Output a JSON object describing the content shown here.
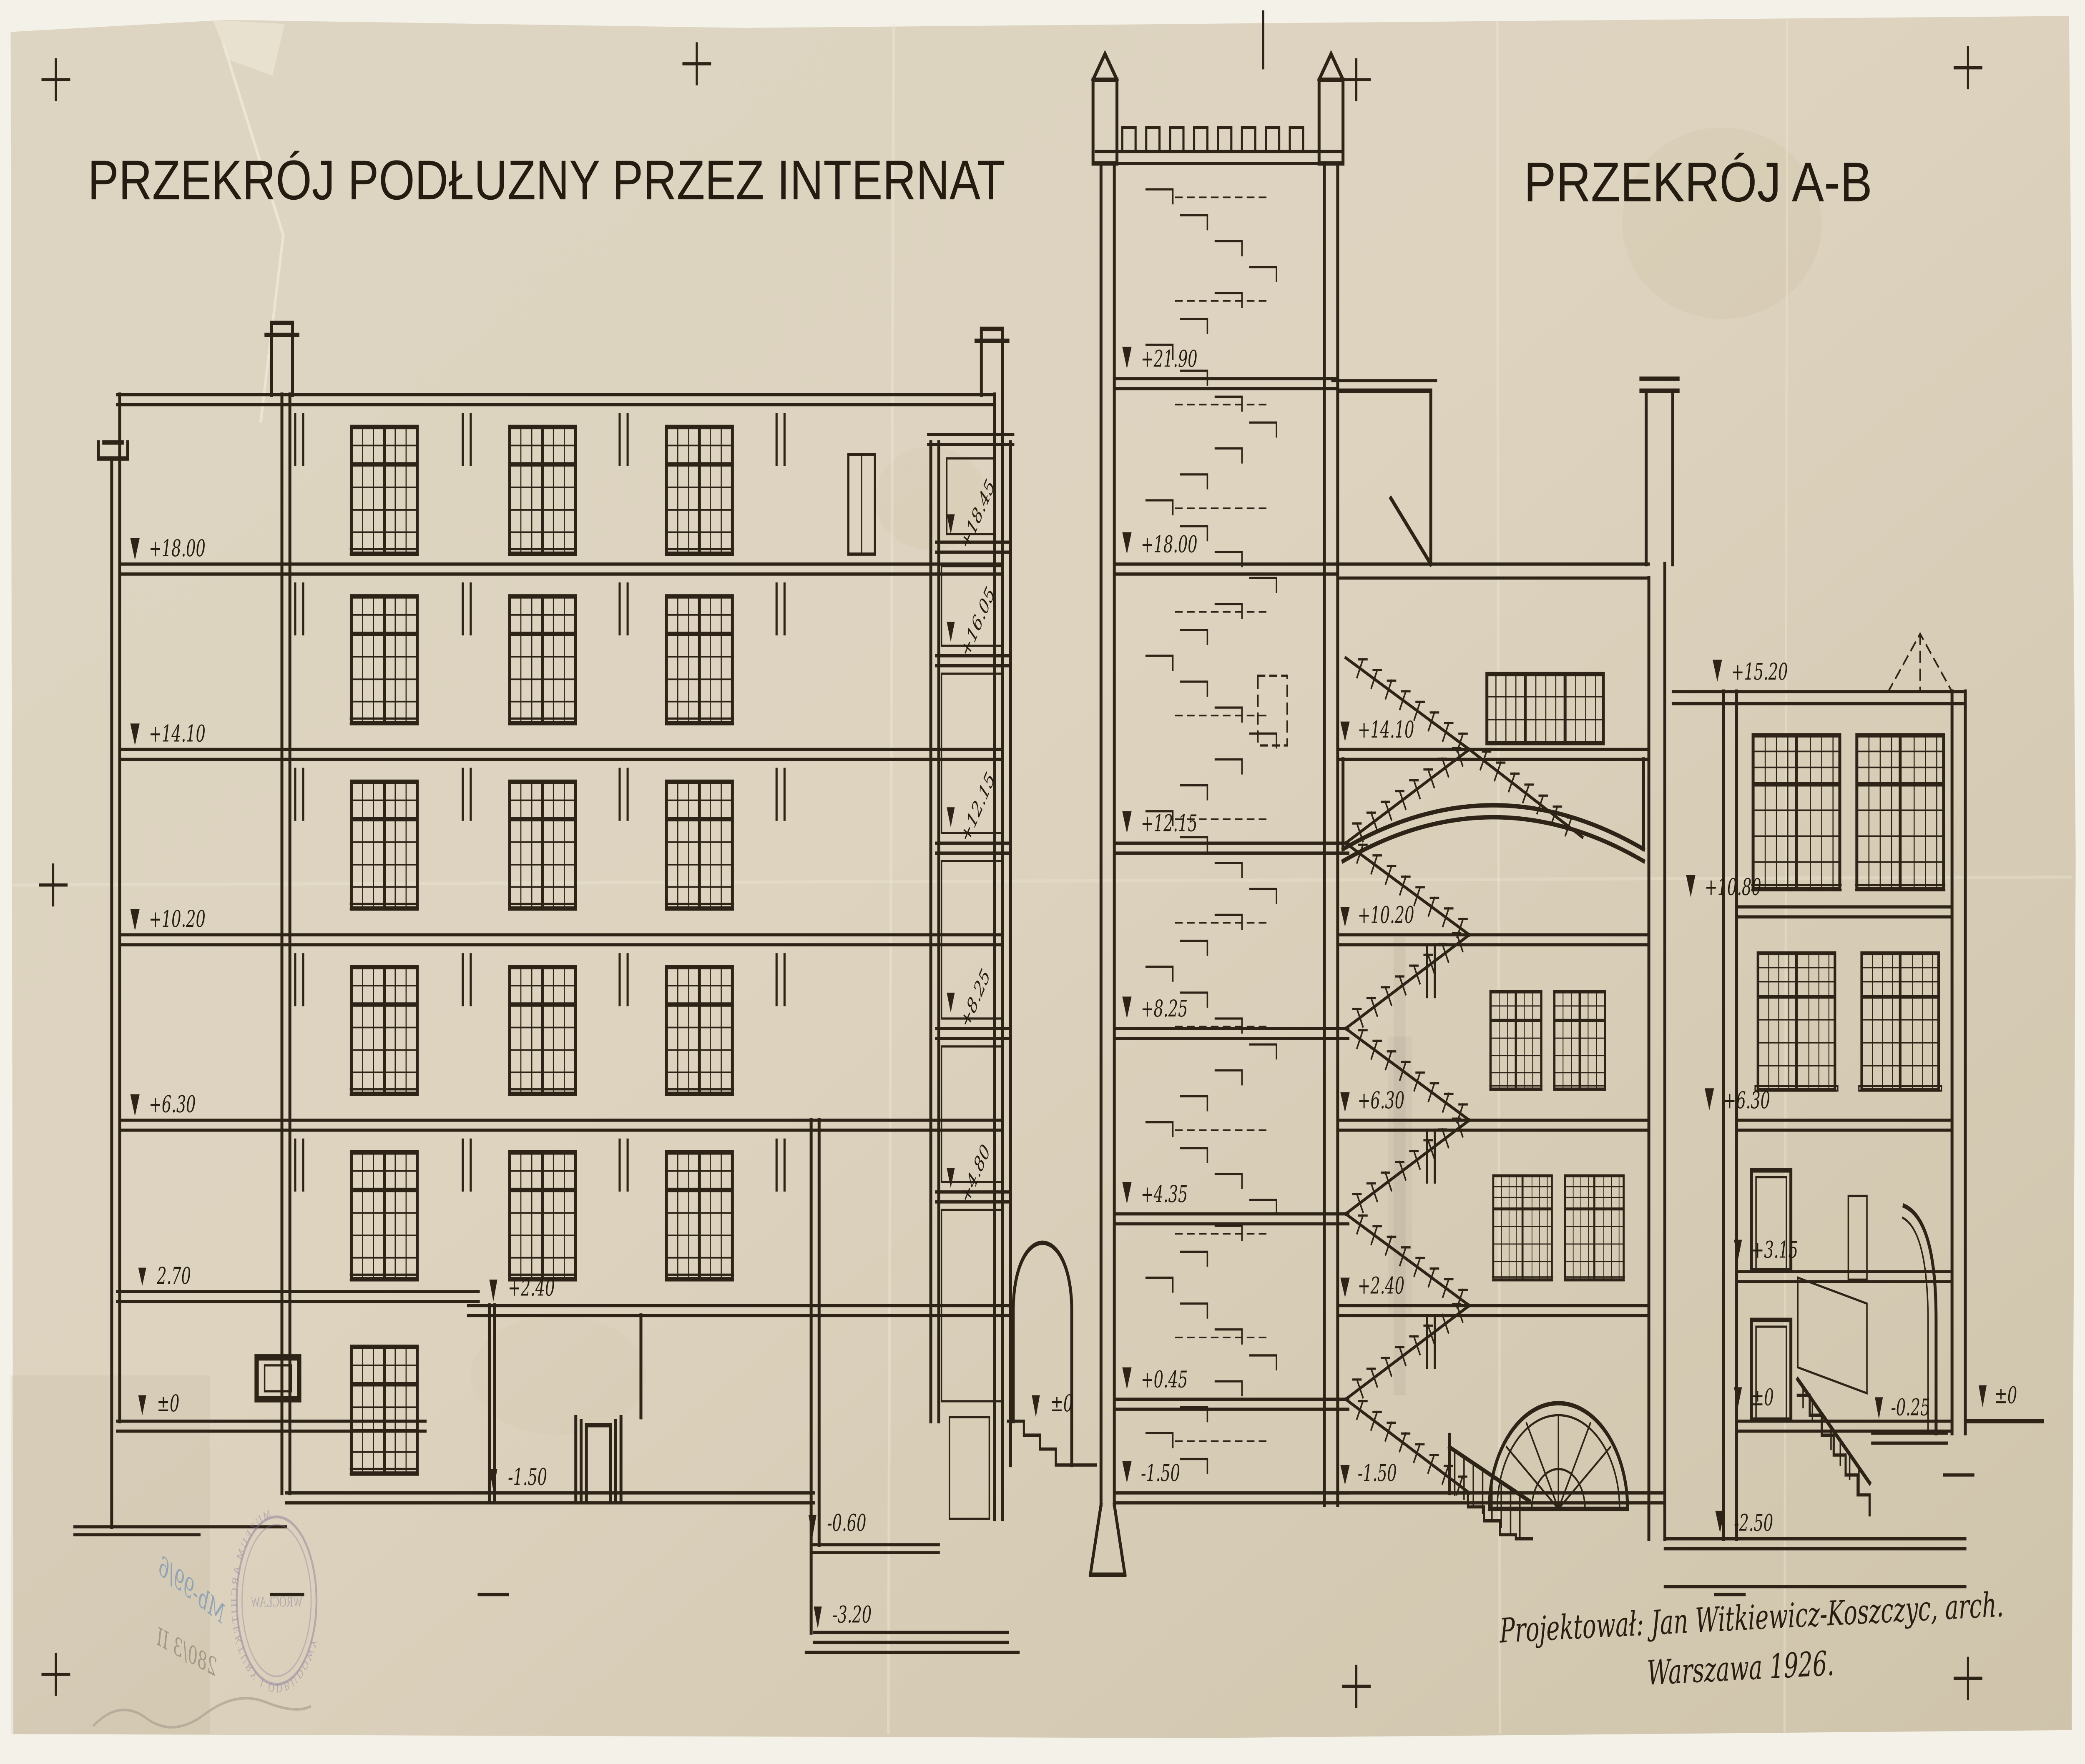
{
  "titles": {
    "left": "PRZEKRÓJ PODŁUZNY PRZEZ INTERNAT",
    "right": "PRZEKRÓJ A-B"
  },
  "left_section": {
    "wall_marks": [
      "+18.00",
      "+14.10",
      "+10.20",
      "+6.30",
      "2.70",
      "±0"
    ],
    "interior_marks": [
      "+2.40",
      "-1.50",
      "-0.60",
      "-3.20",
      "±0"
    ],
    "stair_marks": [
      "+18.45",
      "+16.05",
      "+12.15",
      "+8.25",
      "+4.80"
    ]
  },
  "section_ab": {
    "tower_marks": [
      "+21.90",
      "+18.00",
      "+12.15",
      "+8.25",
      "+4.35",
      "+0.45",
      "-1.50"
    ],
    "center_marks": [
      "+14.10",
      "+10.20",
      "+6.30",
      "+2.40",
      "-1.50"
    ],
    "right_marks": [
      "+15.20",
      "+10.80",
      "+6.30",
      "+3.15",
      "±0",
      "-2.50"
    ],
    "far_right_marks": [
      "-0.25",
      "±0"
    ]
  },
  "signature": {
    "line1": "Projektował: Jan Witkiewicz-Koszczyc, arch.",
    "line2": "Warszawa 1926."
  },
  "stamps": {
    "oval_ring": "MUZEUM ARCHITEKTURY I ODBUDOWY",
    "oval_center": "WROCŁAW",
    "inventory_blue": "Mb-99/6",
    "inventory_pencil": "280/3 II"
  },
  "colors": {
    "paper": "#dcd2bf",
    "ink": "#2d2316",
    "stamp_violet": "#7e6f96",
    "note_blue": "#7c98b4"
  }
}
